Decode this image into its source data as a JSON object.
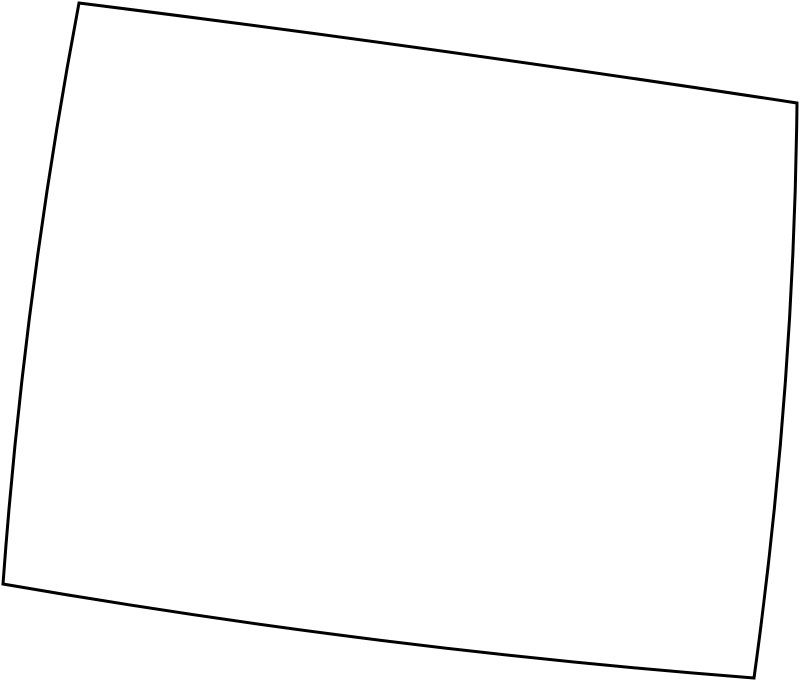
{
  "canvas": {
    "width": "800",
    "height": "683",
    "background": "#ffffff"
  },
  "map": {
    "kind": "blank-state-outline",
    "viewbox": "0 0 800 683",
    "outline_path": "M 79 3 Q 438 48 797 103 Q 794 390 754 678 Q 378 649 3 584 Q 24 294 79 3 Z",
    "stroke_color": "#000000",
    "stroke_width": "3",
    "fill_color": "#ffffff"
  }
}
